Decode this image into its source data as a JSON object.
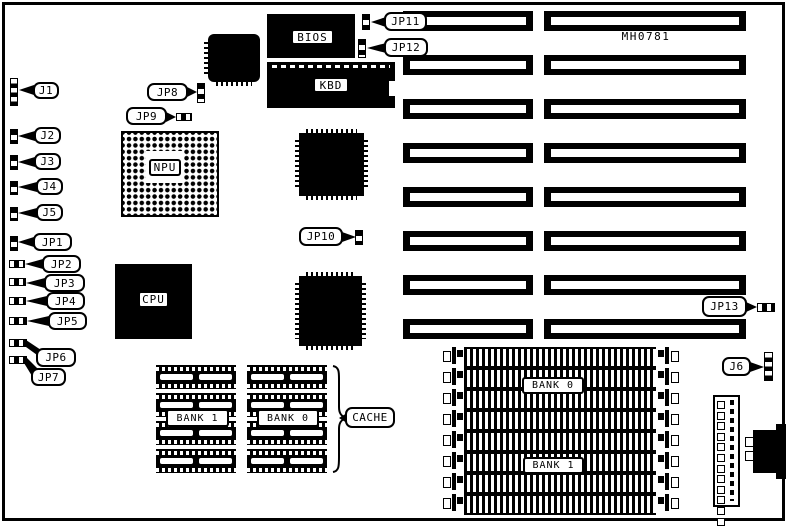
{
  "board_ref": "MH0781",
  "chips": {
    "bios": "BIOS",
    "kbd": "KBD",
    "npu": "NPU",
    "cpu": "CPU"
  },
  "cache": {
    "label": "CACHE",
    "bank_left": "BANK 1",
    "bank_right": "BANK 0"
  },
  "simm": {
    "bank_top": "BANK 0",
    "bank_bottom": "BANK 1"
  },
  "callouts": {
    "j1": "J1",
    "j2": "J2",
    "j3": "J3",
    "j4": "J4",
    "j5": "J5",
    "j6": "J6",
    "jp1": "JP1",
    "jp2": "JP2",
    "jp3": "JP3",
    "jp4": "JP4",
    "jp5": "JP5",
    "jp6": "JP6",
    "jp7": "JP7",
    "jp8": "JP8",
    "jp9": "JP9",
    "jp10": "JP10",
    "jp11": "JP11",
    "jp12": "JP12",
    "jp13": "JP13"
  },
  "counts": {
    "expansion_slot_rows": 8,
    "slot_columns": 2,
    "simm_sockets": 8,
    "cache_chips_per_column": 4,
    "cache_columns": 2,
    "power_connector_pins": 12
  },
  "colors": {
    "ink": "#000000",
    "paper": "#ffffff"
  }
}
